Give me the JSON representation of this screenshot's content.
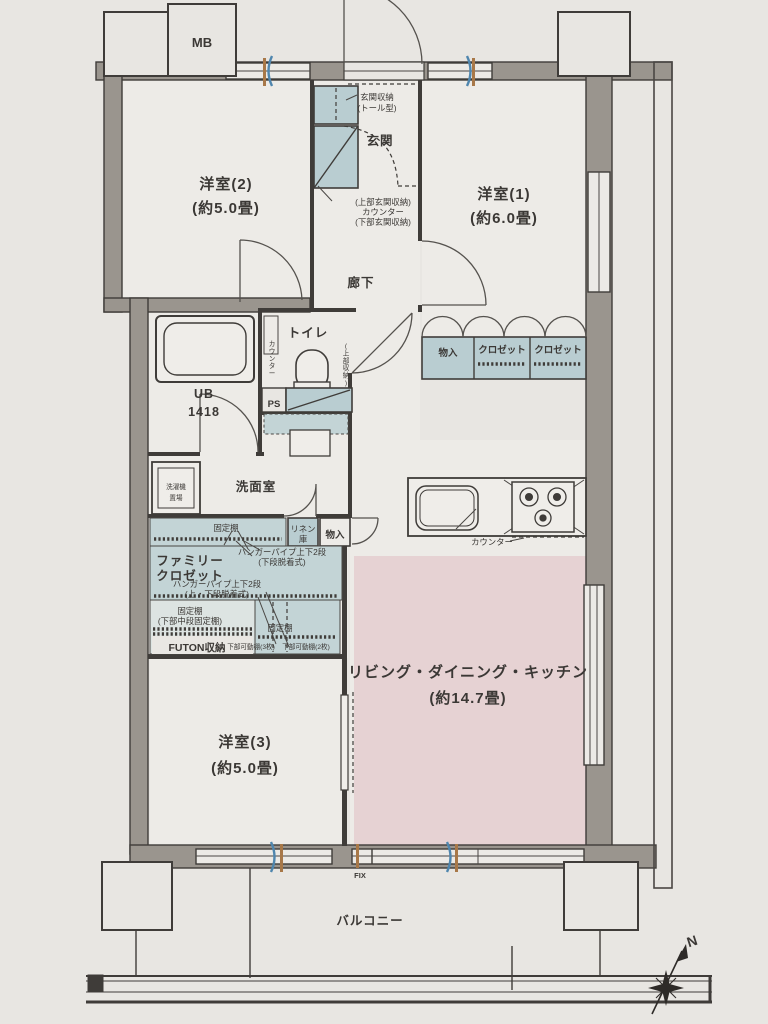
{
  "meta": {
    "kind": "apartment-floorplan"
  },
  "colors": {
    "paper": "#e8e6e2",
    "room_fill": "#edebe7",
    "wall_fill": "#9a958e",
    "line": "#3f3c39",
    "cabinet_blue": "#b9cdd1",
    "ldk_pink": "#e6d2d3",
    "accent_wood": "#a87848",
    "accent_blue": "#4f86ae"
  },
  "rooms": {
    "bed2_name": "洋室(2)",
    "bed2_size": "(約5.0畳)",
    "bed1_name": "洋室(1)",
    "bed1_size": "(約6.0畳)",
    "bed3_name": "洋室(3)",
    "bed3_size": "(約5.0畳)",
    "ldk_name": "リビング・ダイニング・キッチン",
    "ldk_size": "(約14.7畳)",
    "genkan": "玄関",
    "rouka": "廊下",
    "toilet": "トイレ",
    "senmenshitsu": "洗面室",
    "ub_line1": "UB",
    "ub_line2": "1418",
    "balcony": "バルコニー"
  },
  "storage": {
    "genkan_storage": "玄関収納",
    "genkan_storage_type": "(トール型)",
    "genkan_counter_top": "(上部玄関収納)",
    "genkan_counter_mid": "カウンター",
    "genkan_counter_bottom": "(下部玄関収納)",
    "toilet_counter": "カウンター",
    "toilet_upper": "(上部収納)",
    "monoire_a": "物入",
    "closet_a": "クロゼット",
    "closet_b": "クロゼット",
    "washer_line1": "洗濯機",
    "washer_line2": "置場",
    "linen_line1": "リネン",
    "linen_line2": "庫",
    "monoire_b": "物入",
    "fixed_shelf_a": "固定棚",
    "family_closet_line1": "ファミリー",
    "family_closet_line2": "クロゼット",
    "hanger_a_line1": "ハンガーパイプ上下2段",
    "hanger_a_line2": "(下段脱着式)",
    "hanger_b_line1": "ハンガーパイプ上下2段",
    "hanger_b_line2": "(上・下段脱着式)",
    "fixed_shelf_b_line1": "固定棚",
    "fixed_shelf_b_line2": "(下部中段固定棚)",
    "futon": "FUTON収納",
    "fixed_shelf_c": "固定棚",
    "movable_shelf_a": "下部可動棚(3枚)",
    "movable_shelf_b": "下部可動棚(2枚)",
    "kitchen_counter": "カウンター"
  },
  "labels": {
    "mb": "MB",
    "ps": "PS",
    "fix": "FIX",
    "north": "N"
  }
}
